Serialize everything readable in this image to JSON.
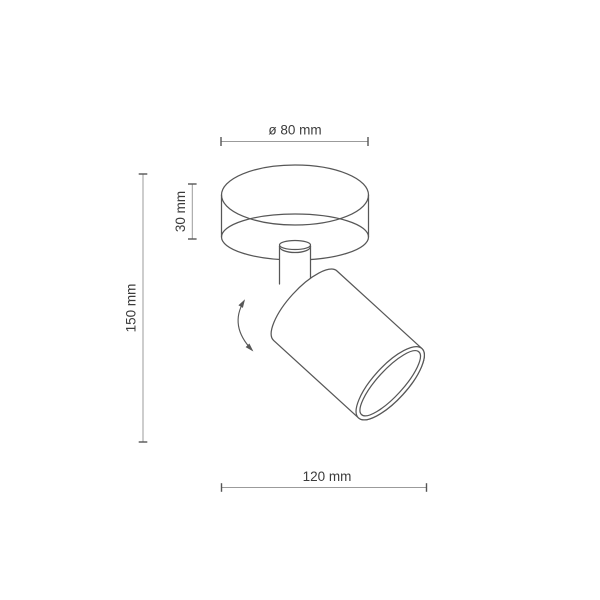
{
  "diagram": {
    "dimensions": {
      "diameter": "ø 80 mm",
      "canopy_height": "30 mm",
      "total_height": "150 mm",
      "width": "120 mm"
    },
    "icons": {
      "rotation_arrow": "curved-double-headed-arrow"
    },
    "colors": {
      "background": "#ffffff",
      "outline": "#575757",
      "dimline": "#9b9b9b",
      "tick": "#555555",
      "text": "#3c3c3c"
    }
  }
}
